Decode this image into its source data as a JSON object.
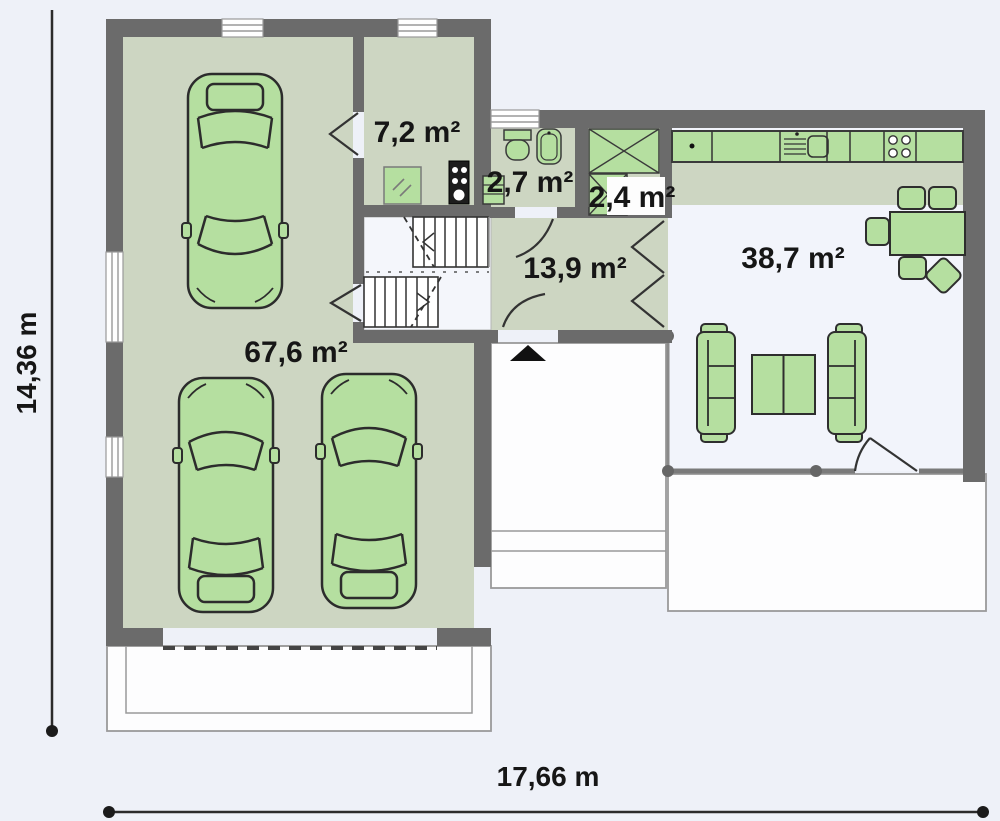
{
  "floorplan": {
    "rooms": {
      "garage": {
        "label": "67,6 m²"
      },
      "utility": {
        "label": "7,2 m²"
      },
      "wc": {
        "label": "2,7 m²"
      },
      "wardrobe": {
        "label": "2,4 m²"
      },
      "hall": {
        "label": "13,9 m²"
      },
      "living": {
        "label": "38,7 m²"
      }
    },
    "dimensions": {
      "total_width": "17,66 m",
      "total_height": "14,36 m"
    },
    "colors": {
      "wall": "#6b6b6b",
      "floor_green": "#cdd6c2",
      "furniture_green": "#b5dfa0",
      "background": "#eef1f8",
      "outline": "#2e2e2e",
      "label_text": "#161616"
    }
  }
}
